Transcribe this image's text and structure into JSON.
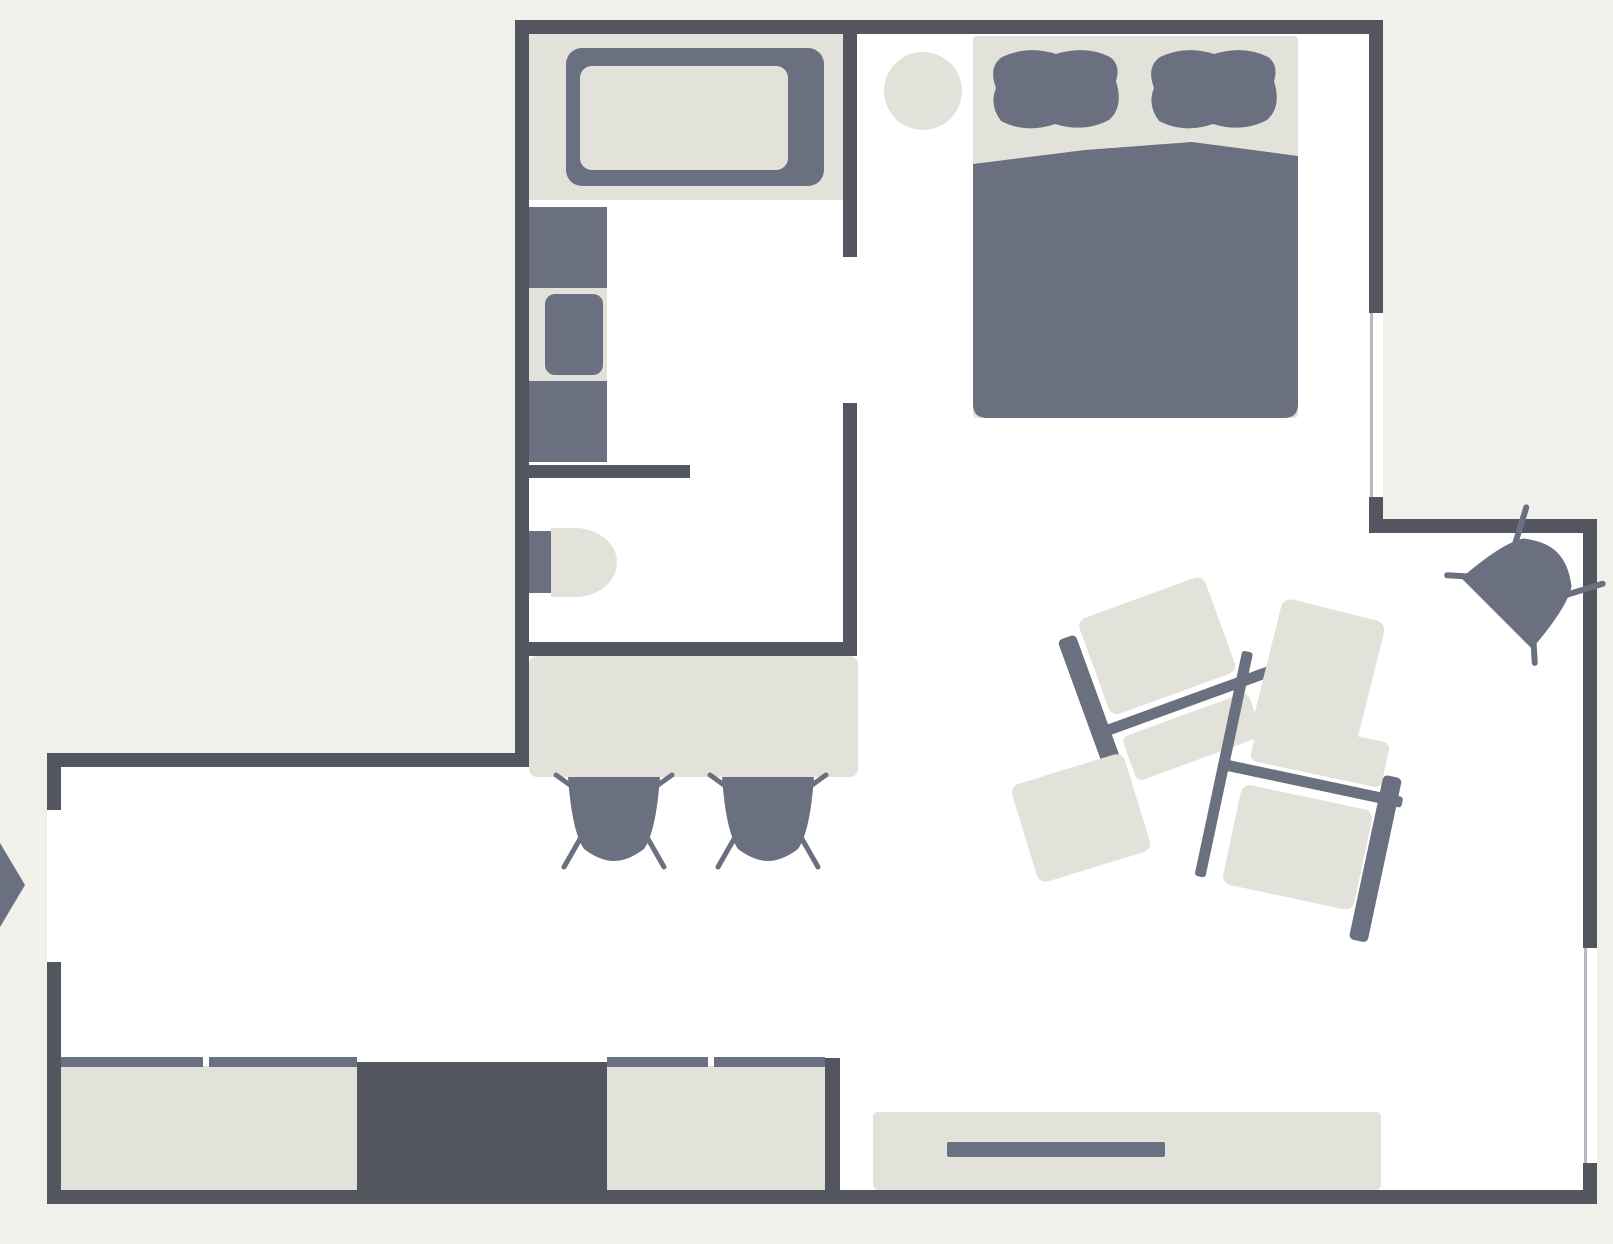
{
  "title": "Studio apartment floor plan",
  "canvas": {
    "width": 1613,
    "height": 1244
  },
  "colors": {
    "background": "#f1f0ea",
    "floor": "#ffffff",
    "wall": "#54565f",
    "furniture_dark": "#6b7080",
    "furniture_light": "#e3e2da",
    "window_frame": "#b9bac0"
  },
  "rooms": [
    {
      "name": "Bathroom"
    },
    {
      "name": "Bedroom"
    },
    {
      "name": "Living room"
    },
    {
      "name": "Hallway"
    }
  ],
  "entrance": {
    "symbol": "entrance-arrow",
    "side": "west"
  },
  "windows": [
    {
      "id": "bedroom-window",
      "wall": "east-upper"
    },
    {
      "id": "living-window",
      "wall": "east-lower"
    }
  ],
  "doors": [
    {
      "id": "entrance-door",
      "location": "west-wall"
    },
    {
      "id": "bathroom-door",
      "location": "bathroom-east-wall"
    }
  ],
  "furniture": {
    "bathtub": {
      "label": "Bathtub"
    },
    "washbasin": {
      "label": "Washbasin with cabinet"
    },
    "toilet": {
      "label": "Toilet"
    },
    "dining_table": {
      "label": "Dining table"
    },
    "dining_chairs": {
      "label": "Dining chair",
      "count": 2
    },
    "bed": {
      "label": "Double bed",
      "pillows": 2
    },
    "bedside_stool": {
      "label": "Round bedside stool"
    },
    "corner_chair": {
      "label": "Chair"
    },
    "sofa_set": {
      "label": "Modular sofa set",
      "pieces": [
        "sofa-left",
        "sofa-right",
        "ottoman",
        "floor-cushion"
      ]
    },
    "wardrobe_left": {
      "label": "Sliding-door wardrobe",
      "doors": 2
    },
    "closet": {
      "label": "Closet unit"
    },
    "wardrobe_right": {
      "label": "Sliding-door wardrobe",
      "doors": 2
    },
    "tv_console": {
      "label": "TV console"
    },
    "tv": {
      "label": "Television"
    }
  }
}
